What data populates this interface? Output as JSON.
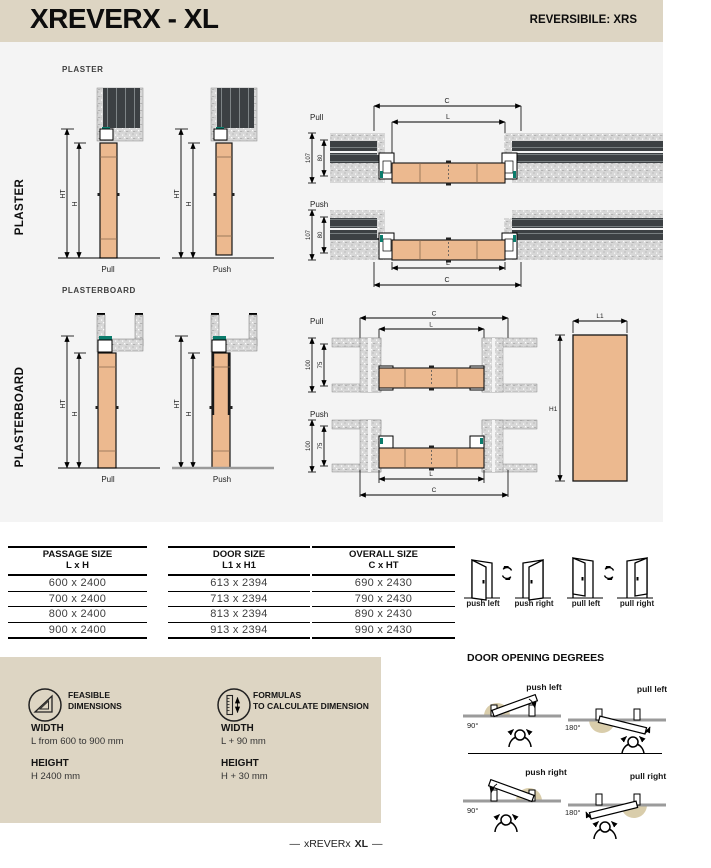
{
  "header": {
    "title": "XREVERX - XL",
    "reversible": "REVERSIBILE: XRS"
  },
  "side_labels": {
    "plaster": "PLASTER",
    "plasterboard": "PLASTERBOARD"
  },
  "drawings": {
    "plaster_section_label": "PLASTER",
    "plasterboard_section_label": "PLASTERBOARD",
    "pull_label": "Pull",
    "push_label": "Push",
    "dim_ht": "HT",
    "dim_h": "H",
    "dim_c": "C",
    "dim_l": "L",
    "dim_l1": "L1",
    "dim_h1": "H1",
    "plaster_wall_depth": "107",
    "plaster_frame_depth": "80",
    "plasterboard_wall_depth": "100",
    "plasterboard_frame_depth": "75"
  },
  "tables": [
    {
      "title": "PASSAGE SIZE",
      "subtitle": "L x H",
      "rows": [
        "600 x 2400",
        "700 x 2400",
        "800 x 2400",
        "900 x 2400"
      ]
    },
    {
      "title": "DOOR SIZE",
      "subtitle": "L1 x H1",
      "rows": [
        "613 x 2394",
        "713 x 2394",
        "813 x 2394",
        "913 x 2394"
      ]
    },
    {
      "title": "OVERALL SIZE",
      "subtitle": "C x HT",
      "rows": [
        "690 x 2430",
        "790 x 2430",
        "890 x 2430",
        "990 x 2430"
      ]
    }
  ],
  "door_modes": {
    "push_left": "push left",
    "push_right": "push right",
    "pull_left": "pull left",
    "pull_right": "pull right"
  },
  "info_box": {
    "feasible": {
      "title1": "FEASIBLE",
      "title2": "DIMENSIONS",
      "width_label": "WIDTH",
      "width_value": "L from 600 to 900 mm",
      "height_label": "HEIGHT",
      "height_value": "H 2400 mm"
    },
    "formulas": {
      "title1": "FORMULAS",
      "title2": "TO CALCULATE DIMENSION",
      "width_label": "WIDTH",
      "width_value": "L + 90 mm",
      "height_label": "HEIGHT",
      "height_value": "H + 30 mm"
    }
  },
  "opening_degrees": {
    "title": "DOOR OPENING DEGREES",
    "push_left": {
      "label": "push left",
      "degrees": "90°"
    },
    "pull_left": {
      "label": "pull left",
      "degrees": "180°"
    },
    "push_right": {
      "label": "push right",
      "degrees": "90°"
    },
    "pull_right": {
      "label": "pull right",
      "degrees": "180°"
    }
  },
  "footer": {
    "dash": "—",
    "name": "xREVERx",
    "model": "XL"
  },
  "colors": {
    "header_beige": "#ddd5c3",
    "panel_gray": "#f4f4f4",
    "door_tan": "#ecb98f",
    "wall_dark": "#3c4043",
    "gasket_teal": "#0b7c6c",
    "arc_beige": "#d9cdab"
  }
}
